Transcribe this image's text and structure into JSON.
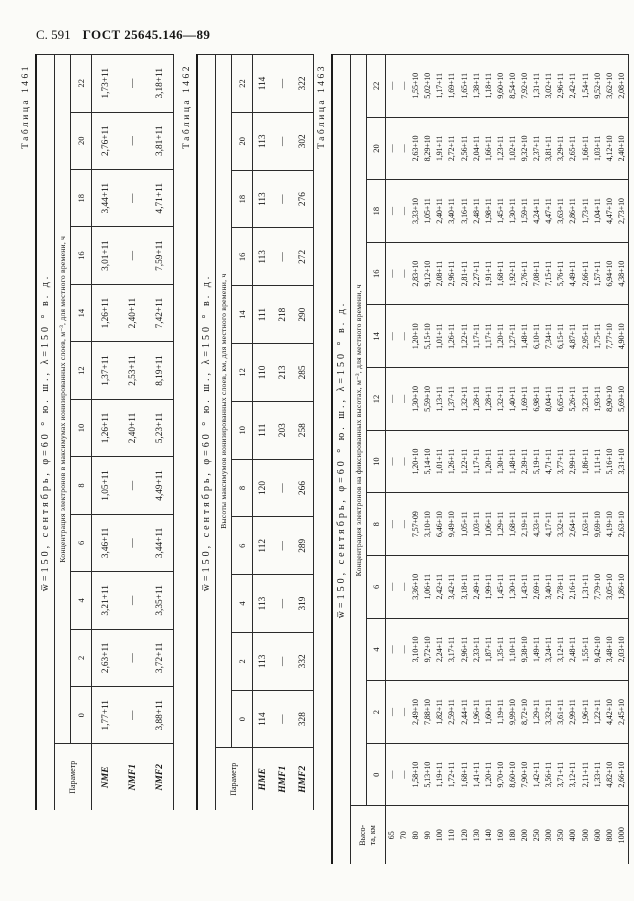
{
  "page_header": {
    "page_label": "С. 591",
    "doc_number": "ГОСТ 25645.146—89"
  },
  "tables": [
    {
      "caption": "Таблица 1461",
      "title": "w̅=150, сентябрь, φ=60 ° ю. ш., λ=150 ° в. д.",
      "unit_header": "Концентрация электронов в максимумах ионизированных слоев, м⁻³, для местного времени, ч",
      "row_header": "Параметр",
      "hours": [
        "0",
        "2",
        "4",
        "6",
        "8",
        "10",
        "12",
        "14",
        "16",
        "18",
        "20",
        "22"
      ],
      "rows": [
        {
          "label": "NME",
          "values": [
            "1,77+11",
            "2,63+11",
            "3,21+11",
            "3,46+11",
            "1,05+11",
            "1,26+11",
            "1,37+11",
            "1,26+11",
            "3,01+11",
            "3,44+11",
            "2,76+11",
            "1,73+11"
          ]
        },
        {
          "label": "NMF1",
          "values": [
            "—",
            "—",
            "—",
            "—",
            "—",
            "2,40+11",
            "2,53+11",
            "2,40+11",
            "—",
            "—",
            "—",
            "—"
          ]
        },
        {
          "label": "NMF2",
          "values": [
            "3,88+11",
            "3,72+11",
            "3,35+11",
            "3,44+11",
            "4,49+11",
            "5,23+11",
            "8,19+11",
            "7,42+11",
            "7,59+11",
            "4,71+11",
            "3,81+11",
            "3,18+11"
          ]
        }
      ]
    },
    {
      "caption": "Таблица 1462",
      "title": "w̅=150, сентябрь, φ=60 ° ю. ш., λ=150 ° в. д.",
      "unit_header": "Высоты максимумов ионизированных слоев, км, для местного времени, ч",
      "row_header": "Параметр",
      "hours": [
        "0",
        "2",
        "4",
        "6",
        "8",
        "10",
        "12",
        "14",
        "16",
        "18",
        "20",
        "22"
      ],
      "rows": [
        {
          "label": "HME",
          "values": [
            "114",
            "113",
            "113",
            "112",
            "120",
            "111",
            "110",
            "111",
            "113",
            "113",
            "113",
            "114"
          ]
        },
        {
          "label": "HMF1",
          "values": [
            "—",
            "—",
            "—",
            "—",
            "—",
            "203",
            "213",
            "218",
            "—",
            "—",
            "—",
            "—"
          ]
        },
        {
          "label": "HMF2",
          "values": [
            "328",
            "332",
            "319",
            "289",
            "266",
            "258",
            "285",
            "290",
            "272",
            "276",
            "302",
            "322"
          ]
        }
      ]
    },
    {
      "caption": "Таблица 1463",
      "title": "w̅=150, сентябрь, φ=60 ° ю. ш., λ=150 ° в. д.",
      "unit_header": "Концентрация электронов на фиксированных высотах, м⁻³, для местного времени, ч",
      "row_header": "Высо-\nта, км",
      "hours": [
        "0",
        "2",
        "4",
        "6",
        "8",
        "10",
        "12",
        "14",
        "16",
        "18",
        "20",
        "22"
      ],
      "rows": [
        {
          "label": "65",
          "values": [
            "—",
            "—",
            "—",
            "—",
            "—",
            "—",
            "—",
            "—",
            "—",
            "—",
            "—",
            "—"
          ]
        },
        {
          "label": "70",
          "values": [
            "—",
            "—",
            "—",
            "—",
            "—",
            "—",
            "—",
            "—",
            "—",
            "—",
            "—",
            "—"
          ]
        },
        {
          "label": "80",
          "values": [
            "1,58+10",
            "2,49+10",
            "3,10+10",
            "3,36+10",
            "7,57+09",
            "1,20+10",
            "1,30+10",
            "1,20+10",
            "2,83+10",
            "3,33+10",
            "2,63+10",
            "1,55+10"
          ]
        },
        {
          "label": "90",
          "values": [
            "5,13+10",
            "7,88+10",
            "9,72+10",
            "1,06+11",
            "3,10+10",
            "5,14+10",
            "5,59+10",
            "5,15+10",
            "9,12+10",
            "1,05+11",
            "8,29+10",
            "5,02+10"
          ]
        },
        {
          "label": "100",
          "values": [
            "1,19+11",
            "1,82+11",
            "2,24+11",
            "2,42+11",
            "6,46+10",
            "1,01+11",
            "1,13+11",
            "1,01+11",
            "2,08+11",
            "2,40+11",
            "1,91+11",
            "1,17+11"
          ]
        },
        {
          "label": "110",
          "values": [
            "1,72+11",
            "2,59+11",
            "3,17+11",
            "3,42+11",
            "9,49+10",
            "1,26+11",
            "1,37+11",
            "1,26+11",
            "2,96+11",
            "3,40+11",
            "2,72+11",
            "1,69+11"
          ]
        },
        {
          "label": "120",
          "values": [
            "1,68+11",
            "2,44+11",
            "2,96+11",
            "3,18+11",
            "1,05+11",
            "1,22+11",
            "1,32+11",
            "1,22+11",
            "2,81+11",
            "3,16+11",
            "2,56+11",
            "1,65+11"
          ]
        },
        {
          "label": "130",
          "values": [
            "1,41+11",
            "1,96+11",
            "2,33+11",
            "2,49+11",
            "1,03+11",
            "1,17+11",
            "1,28+11",
            "1,17+11",
            "2,27+11",
            "2,48+11",
            "2,04+11",
            "1,38+11"
          ]
        },
        {
          "label": "140",
          "values": [
            "1,20+11",
            "1,60+11",
            "1,87+11",
            "1,99+11",
            "1,06+11",
            "1,20+11",
            "1,28+11",
            "1,17+11",
            "1,91+11",
            "1,98+11",
            "1,66+11",
            "1,18+11"
          ]
        },
        {
          "label": "160",
          "values": [
            "9,70+10",
            "1,19+11",
            "1,35+11",
            "1,45+11",
            "1,29+11",
            "1,30+11",
            "1,32+11",
            "1,20+11",
            "1,68+11",
            "1,45+11",
            "1,23+11",
            "9,60+10"
          ]
        },
        {
          "label": "180",
          "values": [
            "8,60+10",
            "9,99+10",
            "1,10+11",
            "1,30+11",
            "1,68+11",
            "1,48+11",
            "1,40+11",
            "1,27+11",
            "1,92+11",
            "1,30+11",
            "1,02+11",
            "8,54+10"
          ]
        },
        {
          "label": "200",
          "values": [
            "7,90+10",
            "8,72+10",
            "9,38+10",
            "1,43+11",
            "2,19+11",
            "2,39+11",
            "1,69+11",
            "1,48+11",
            "2,76+11",
            "1,59+11",
            "9,32+10",
            "7,92+10"
          ]
        },
        {
          "label": "250",
          "values": [
            "1,42+11",
            "1,29+11",
            "1,49+11",
            "2,69+11",
            "4,33+11",
            "5,19+11",
            "6,98+11",
            "6,10+11",
            "7,08+11",
            "4,24+11",
            "2,37+11",
            "1,31+11"
          ]
        },
        {
          "label": "300",
          "values": [
            "3,56+11",
            "3,32+11",
            "3,24+11",
            "3,40+11",
            "4,17+11",
            "4,71+11",
            "8,04+11",
            "7,34+11",
            "7,15+11",
            "4,47+11",
            "3,81+11",
            "3,02+11"
          ]
        },
        {
          "label": "350",
          "values": [
            "3,71+11",
            "3,61+11",
            "3,12+11",
            "2,78+11",
            "3,32+11",
            "3,77+11",
            "6,65+11",
            "6,15+11",
            "5,76+11",
            "3,63+11",
            "3,29+11",
            "2,96+11"
          ]
        },
        {
          "label": "400",
          "values": [
            "3,12+11",
            "2,99+11",
            "2,48+11",
            "2,16+11",
            "2,64+11",
            "2,99+11",
            "5,26+11",
            "4,87+11",
            "4,49+11",
            "2,86+11",
            "2,65+11",
            "2,42+11"
          ]
        },
        {
          "label": "500",
          "values": [
            "2,11+11",
            "1,96+11",
            "1,55+11",
            "1,31+11",
            "1,63+11",
            "1,86+11",
            "3,23+11",
            "2,95+11",
            "2,66+11",
            "1,73+11",
            "1,66+11",
            "1,54+11"
          ]
        },
        {
          "label": "600",
          "values": [
            "1,33+11",
            "1,22+11",
            "9,42+10",
            "7,79+10",
            "9,69+10",
            "1,11+11",
            "1,93+11",
            "1,75+11",
            "1,57+11",
            "1,04+11",
            "1,03+11",
            "9,52+10"
          ]
        },
        {
          "label": "800",
          "values": [
            "4,82+10",
            "4,42+10",
            "3,48+10",
            "3,05+10",
            "4,19+10",
            "5,16+10",
            "8,90+10",
            "7,77+10",
            "6,94+10",
            "4,47+10",
            "4,12+10",
            "3,62+10"
          ]
        },
        {
          "label": "1000",
          "values": [
            "2,66+10",
            "2,45+10",
            "2,03+10",
            "1,86+10",
            "2,63+10",
            "3,31+10",
            "5,69+10",
            "4,90+10",
            "4,38+10",
            "2,73+10",
            "2,40+10",
            "2,08+10"
          ]
        }
      ]
    }
  ]
}
